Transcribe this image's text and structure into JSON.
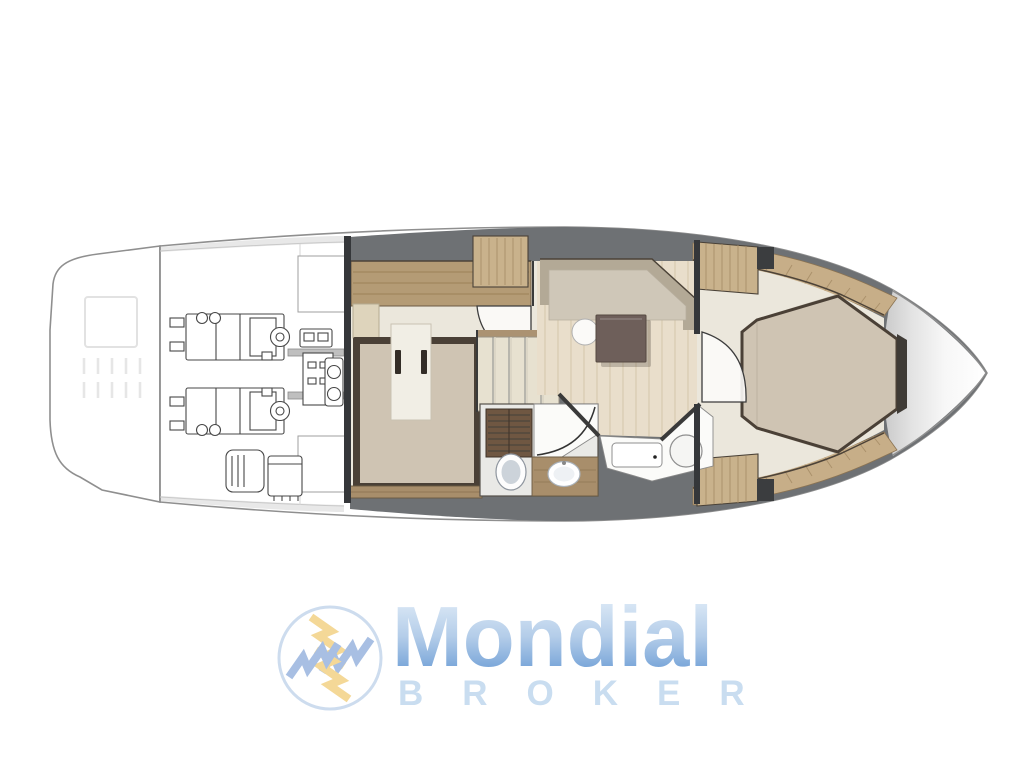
{
  "logo": {
    "brand": "Mondial",
    "subtitle": "BROKER",
    "icon_name": "pinwheel-lightning-icon",
    "brand_gradient_top": "#d9e7f5",
    "brand_gradient_bottom": "#6f9fd6",
    "subtitle_color": "#c9ddf0",
    "icon_yellow": "#f3d48c",
    "icon_blue": "#9fb9e0",
    "icon_ring": "#cddcee"
  },
  "floorplan": {
    "name": "yacht-lower-deck-floor-plan",
    "areas": [
      "swim-platform",
      "engine-room",
      "aft-cabin",
      "staircase",
      "bathroom",
      "shower-room",
      "galley-salon-dinette",
      "bow-cabin",
      "bow-tip"
    ]
  },
  "colors": {
    "page_bg": "#ffffff",
    "hull_line": "#8f8f8f",
    "deck_grey": "#6e7174",
    "bulkhead": "#35373a",
    "wood_sideboard": "#b49b75",
    "wood_walkway": "#c7ae88",
    "wood_counter": "#a88e6b",
    "wood_louver": "#6f5742",
    "floor_beige": "#ebe7dc",
    "galley_floor": "#e9decb",
    "plank_line": "#d8cbb0",
    "bed_greige": "#cfc4b3",
    "bed_frame": "#4a4036",
    "bed_inset": "#f1eee5",
    "sofa_back": "#b3a996",
    "sofa_seat": "#cfc7b8",
    "table_brown": "#6e5f5a",
    "bath_floor": "#e9e9e6",
    "line_dark": "#3a3a3a"
  }
}
